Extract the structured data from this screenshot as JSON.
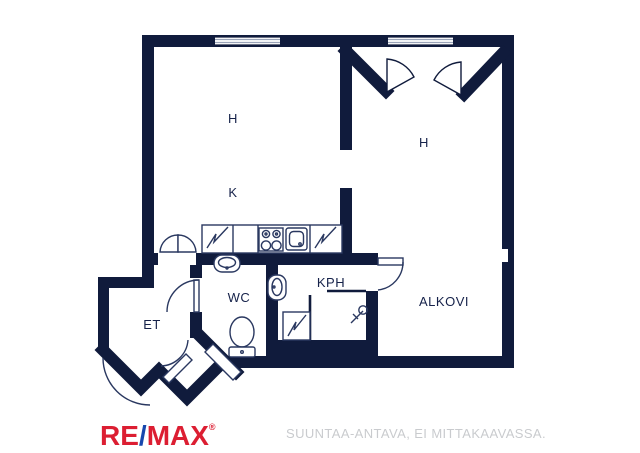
{
  "floor_plan": {
    "wall_color": "#101b3c",
    "floor_color": "#ffffff",
    "room_labels": [
      {
        "name": "room-h-left",
        "text": "H"
      },
      {
        "name": "room-k",
        "text": "K"
      },
      {
        "name": "room-h-right",
        "text": "H"
      },
      {
        "name": "room-wc",
        "text": "WC"
      },
      {
        "name": "room-kph",
        "text": "KPH"
      },
      {
        "name": "room-alkovi",
        "text": "ALKOVI"
      },
      {
        "name": "room-et",
        "text": "ET"
      }
    ],
    "icons": [
      "window-icon",
      "door-swing-arc-icon",
      "bifold-door-icon",
      "corner-door-fan-icon",
      "fridge-cabinet-icon",
      "stove-icon",
      "kitchen-sink-icon",
      "wc-sink-icon",
      "toilet-icon",
      "kph-sink-icon",
      "cabinet-icon",
      "shower-drain-icon",
      "entrance-door-icon"
    ]
  },
  "footer": {
    "logo": {
      "part1": "RE",
      "slash": "/",
      "part2": "MAX",
      "registered": "®",
      "primary_color": "#dc1e32",
      "slash_color": "#1747ad"
    },
    "disclaimer": {
      "text": "SUUNTAA-ANTAVA, EI MITTAKAAVASSA.",
      "color": "#c9cbce"
    }
  }
}
